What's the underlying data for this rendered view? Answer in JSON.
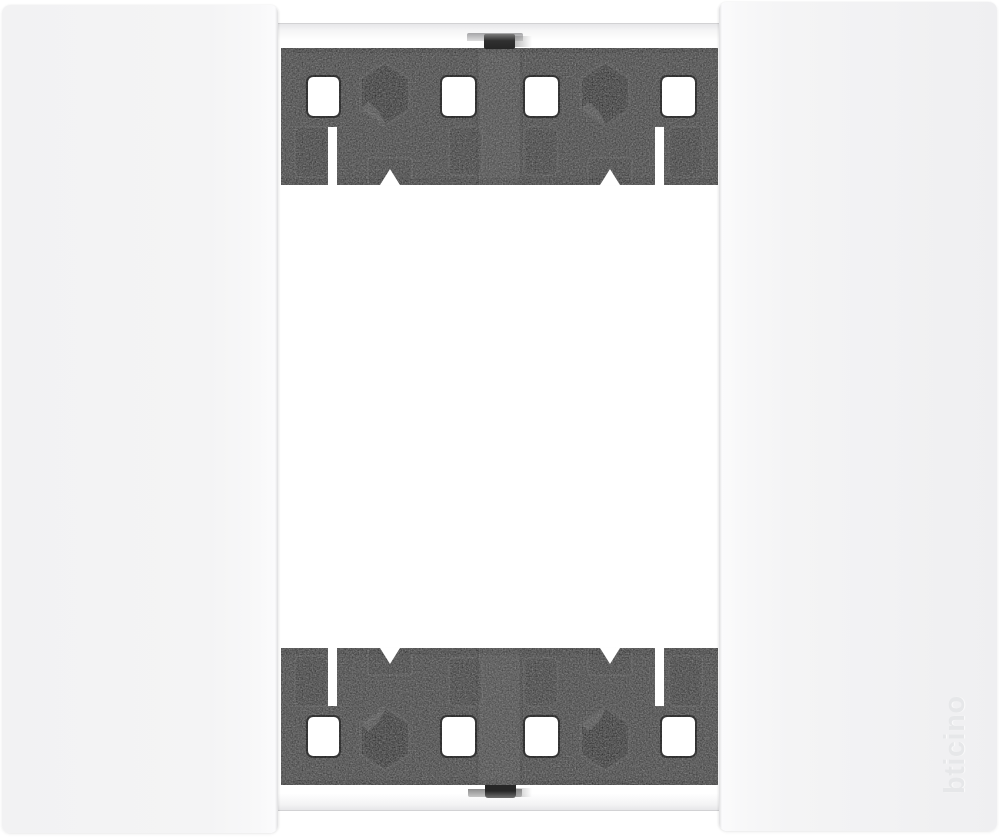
{
  "brand": {
    "logo_text": "bticino"
  },
  "colors": {
    "background": "#ffffff",
    "side_panel": "#f4f4f5",
    "rail_dark": "#353535",
    "hex_hole": "#121212",
    "logo_emboss": "#e6e7e9",
    "strip_edge": "#d2d2d4"
  }
}
